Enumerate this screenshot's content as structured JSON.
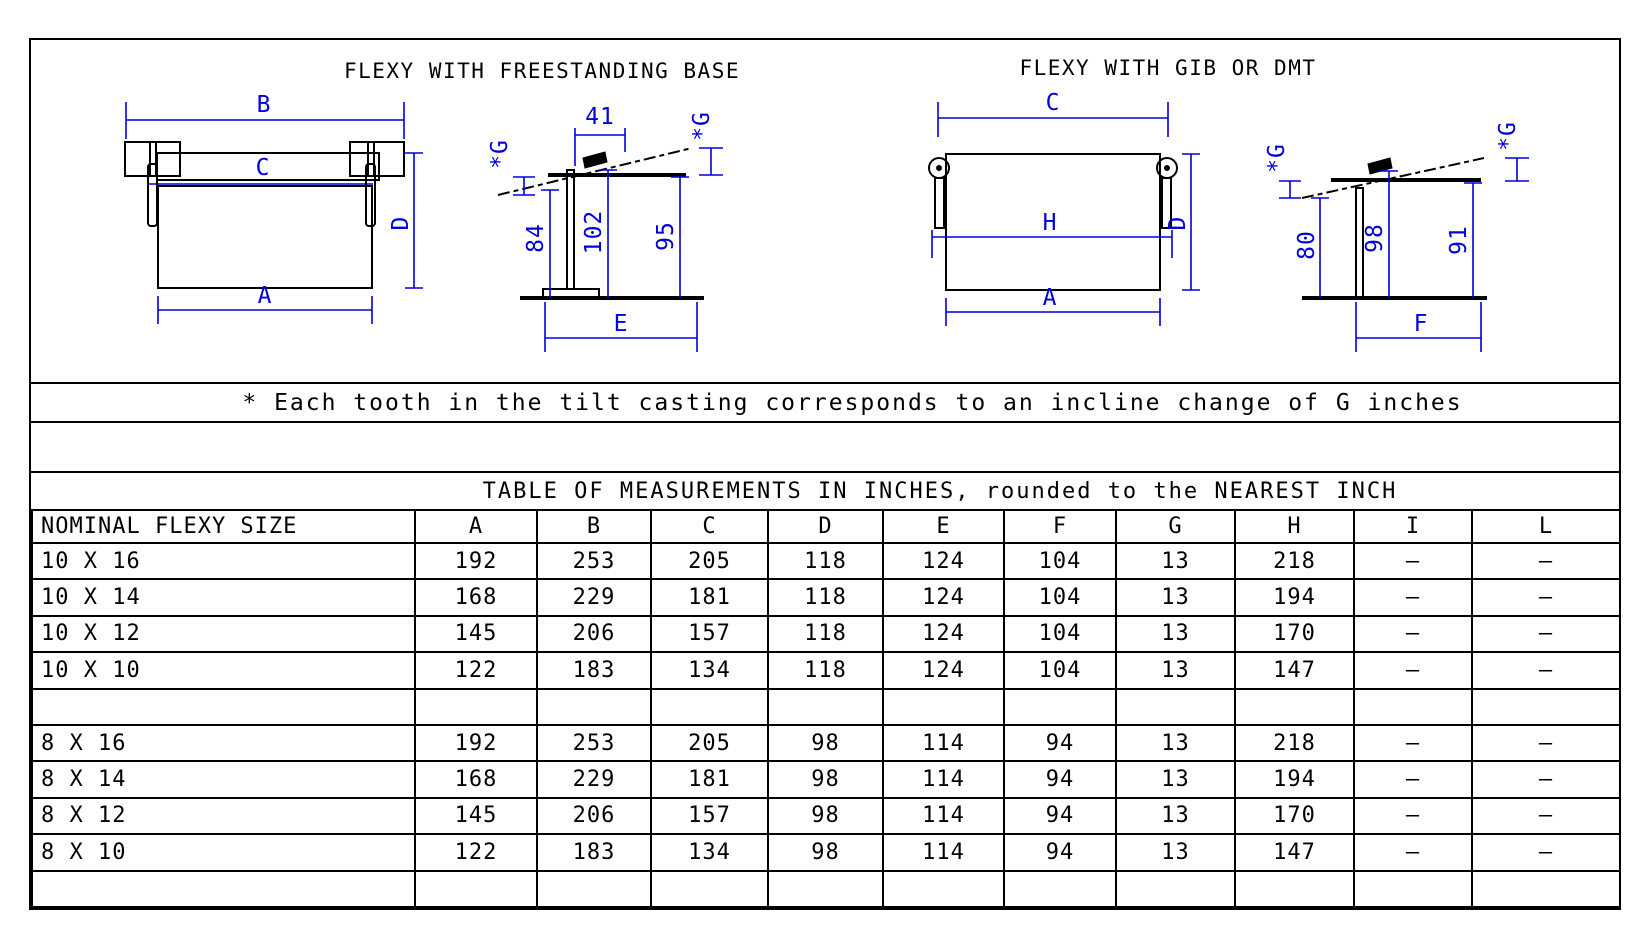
{
  "drawings": {
    "left": {
      "title": "FLEXY WITH FREESTANDING BASE",
      "front": {
        "top": "B",
        "rail": "C",
        "right": "D",
        "bottom": "A"
      },
      "side": {
        "top": "41",
        "g": "*G",
        "h1": "84",
        "h2": "102",
        "h3": "95",
        "bottom": "E"
      }
    },
    "right": {
      "title": "FLEXY WITH GIB OR DMT",
      "front": {
        "top": "C",
        "mid": "H",
        "right": "D",
        "bottom": "A"
      },
      "side": {
        "g": "*G",
        "h1": "80",
        "h2": "98",
        "h3": "91",
        "bottom": "F"
      }
    }
  },
  "note": "* Each tooth in the tilt casting corresponds to an incline change of G inches",
  "table": {
    "title": "TABLE OF MEASUREMENTS IN INCHES, rounded to the NEAREST INCH",
    "columns": [
      "NOMINAL FLEXY SIZE",
      "A",
      "B",
      "C",
      "D",
      "E",
      "F",
      "G",
      "H",
      "I",
      "L"
    ],
    "rows": [
      [
        "10 X 16",
        "192",
        "253",
        "205",
        "118",
        "124",
        "104",
        "13",
        "218",
        "–",
        "–"
      ],
      [
        "10 X 14",
        "168",
        "229",
        "181",
        "118",
        "124",
        "104",
        "13",
        "194",
        "–",
        "–"
      ],
      [
        "10 X 12",
        "145",
        "206",
        "157",
        "118",
        "124",
        "104",
        "13",
        "170",
        "–",
        "–"
      ],
      [
        "10 X 10",
        "122",
        "183",
        "134",
        "118",
        "124",
        "104",
        "13",
        "147",
        "–",
        "–"
      ],
      [
        "",
        "",
        "",
        "",
        "",
        "",
        "",
        "",
        "",
        "",
        ""
      ],
      [
        "8 X 16",
        "192",
        "253",
        "205",
        "98",
        "114",
        "94",
        "13",
        "218",
        "–",
        "–"
      ],
      [
        "8 X 14",
        "168",
        "229",
        "181",
        "98",
        "114",
        "94",
        "13",
        "194",
        "–",
        "–"
      ],
      [
        "8 X 12",
        "145",
        "206",
        "157",
        "98",
        "114",
        "94",
        "13",
        "170",
        "–",
        "–"
      ],
      [
        "8 X 10",
        "122",
        "183",
        "134",
        "98",
        "114",
        "94",
        "13",
        "147",
        "–",
        "–"
      ],
      [
        "",
        "",
        "",
        "",
        "",
        "",
        "",
        "",
        "",
        "",
        ""
      ]
    ]
  },
  "colors": {
    "dimension_blue": "#0000dd",
    "line_black": "#000000"
  }
}
